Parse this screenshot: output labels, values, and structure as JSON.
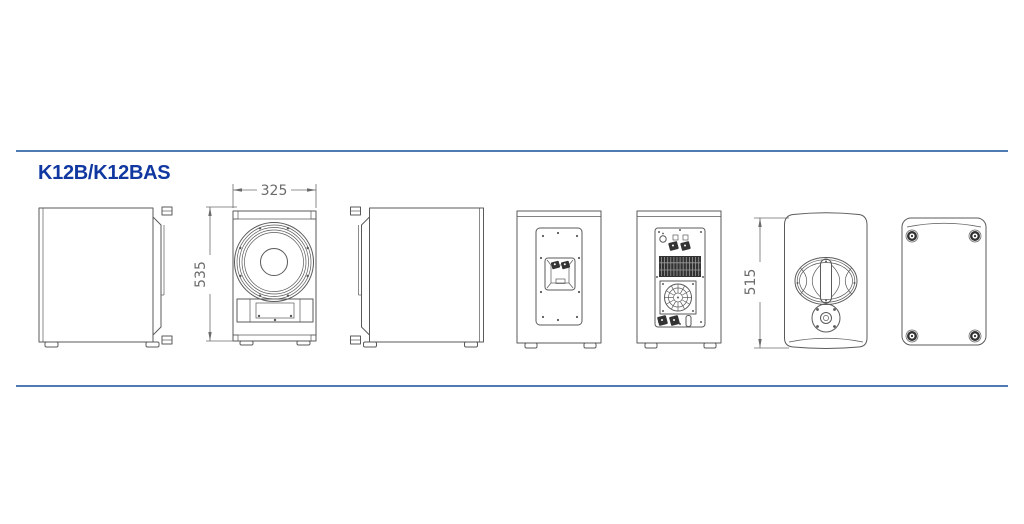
{
  "title": "K12B/K12BAS",
  "dimensions": {
    "front_width_mm": "325",
    "front_height_mm": "535",
    "side_height_mm": "515"
  },
  "colors": {
    "divider_blue": "#4e7cb2",
    "title_blue": "#1038a0",
    "line_gray": "#5a5a5a",
    "dim_gray": "#6b6b6b",
    "dark_fill": "#333333",
    "background": "#ffffff"
  },
  "views": [
    {
      "name": "side-view-left"
    },
    {
      "name": "front-view-woofer-port"
    },
    {
      "name": "side-view-right"
    },
    {
      "name": "rear-view-connector-panel"
    },
    {
      "name": "rear-view-amplifier-panel"
    },
    {
      "name": "side-profile-handle-pole-mount"
    },
    {
      "name": "top-view-feet"
    }
  ]
}
